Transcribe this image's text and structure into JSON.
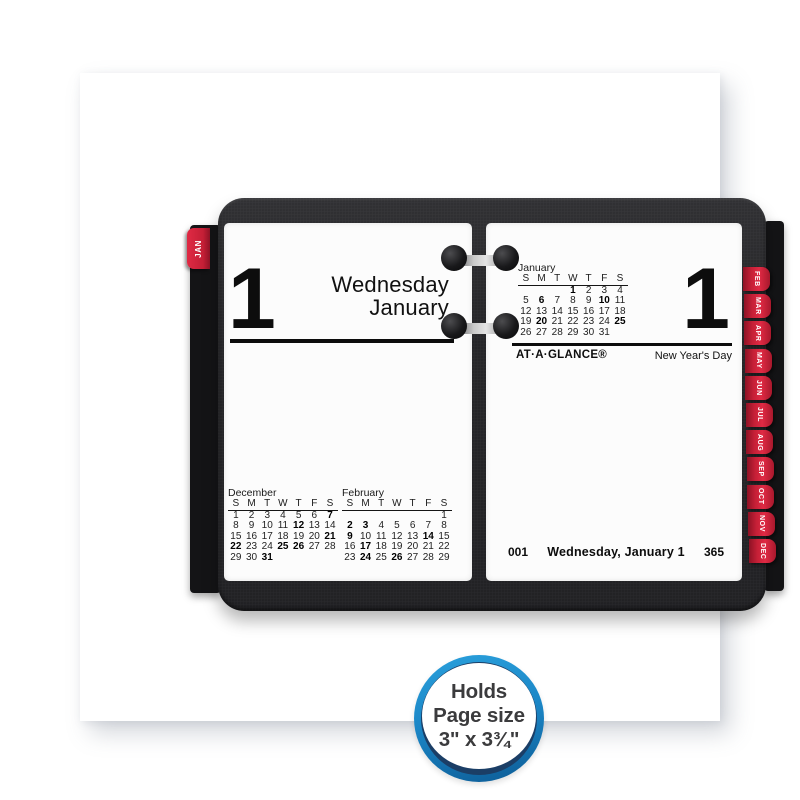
{
  "holder": {
    "jan_tab_label": "JAN",
    "month_tabs": [
      "FEB",
      "MAR",
      "APR",
      "MAY",
      "JUN",
      "JUL",
      "AUG",
      "SEP",
      "OCT",
      "NOV",
      "DEC"
    ]
  },
  "left_page": {
    "day_number": "1",
    "weekday": "Wednesday",
    "month": "January",
    "mini_calendars": [
      {
        "title": "December",
        "headers": [
          "S",
          "M",
          "T",
          "W",
          "T",
          "F",
          "S"
        ],
        "weeks": [
          [
            "1",
            "2",
            "3",
            "4",
            "5",
            "6",
            "7"
          ],
          [
            "8",
            "9",
            "10",
            "11",
            "12",
            "13",
            "14"
          ],
          [
            "15",
            "16",
            "17",
            "18",
            "19",
            "20",
            "21"
          ],
          [
            "22",
            "23",
            "24",
            "25",
            "26",
            "27",
            "28"
          ],
          [
            "29",
            "30",
            "31",
            "",
            "",
            "",
            ""
          ]
        ],
        "bold": [
          "7",
          "12",
          "21",
          "22",
          "25",
          "26",
          "31"
        ]
      },
      {
        "title": "February",
        "headers": [
          "S",
          "M",
          "T",
          "W",
          "T",
          "F",
          "S"
        ],
        "weeks": [
          [
            "",
            "",
            "",
            "",
            "",
            "",
            "1"
          ],
          [
            "2",
            "3",
            "4",
            "5",
            "6",
            "7",
            "8"
          ],
          [
            "9",
            "10",
            "11",
            "12",
            "13",
            "14",
            "15"
          ],
          [
            "16",
            "17",
            "18",
            "19",
            "20",
            "21",
            "22"
          ],
          [
            "23",
            "24",
            "25",
            "26",
            "27",
            "28",
            "29"
          ]
        ],
        "bold": [
          "2",
          "3",
          "9",
          "14",
          "17",
          "24",
          "26"
        ]
      }
    ]
  },
  "right_page": {
    "day_number": "1",
    "mini_calendar": {
      "title": "January",
      "headers": [
        "S",
        "M",
        "T",
        "W",
        "T",
        "F",
        "S"
      ],
      "weeks": [
        [
          "",
          "",
          "",
          "1",
          "2",
          "3",
          "4"
        ],
        [
          "5",
          "6",
          "7",
          "8",
          "9",
          "10",
          "11"
        ],
        [
          "12",
          "13",
          "14",
          "15",
          "16",
          "17",
          "18"
        ],
        [
          "19",
          "20",
          "21",
          "22",
          "23",
          "24",
          "25"
        ],
        [
          "26",
          "27",
          "28",
          "29",
          "30",
          "31",
          ""
        ]
      ],
      "bold": [
        "1",
        "6",
        "10",
        "20",
        "25"
      ]
    },
    "brand": "AT·A·GLANCE®",
    "holiday": "New Year's Day",
    "footer": {
      "day_of_year": "001",
      "date_label": "Wednesday, January 1",
      "days_remaining": "365"
    }
  },
  "badge": {
    "lines": [
      "Holds",
      "Page size",
      "3\" x 3¾\""
    ]
  },
  "colors": {
    "tab_red": "#c41f36",
    "tab_red_light": "#e02a44",
    "badge_blue": "#1b86c6",
    "badge_navy": "#1b3e66"
  }
}
